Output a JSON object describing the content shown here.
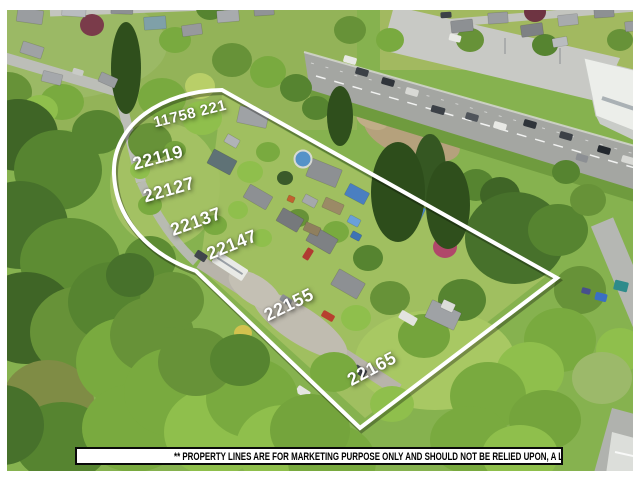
{
  "overlay": {
    "property_line_color": "#ffffff",
    "label_color": "#ffffff",
    "address_labels": [
      {
        "text": "11758 221",
        "x": 190,
        "y": 114,
        "rotation": -14,
        "size": 15
      },
      {
        "text": "22119",
        "x": 158,
        "y": 158,
        "rotation": -15,
        "size": 18
      },
      {
        "text": "22127",
        "x": 169,
        "y": 190,
        "rotation": -16,
        "size": 18
      },
      {
        "text": "22137",
        "x": 196,
        "y": 222,
        "rotation": -20,
        "size": 18
      },
      {
        "text": "22147",
        "x": 232,
        "y": 245,
        "rotation": -22,
        "size": 18
      },
      {
        "text": "22155",
        "x": 289,
        "y": 305,
        "rotation": -26,
        "size": 18
      },
      {
        "text": "22165",
        "x": 372,
        "y": 369,
        "rotation": -28,
        "size": 18
      }
    ]
  },
  "disclaimer": {
    "text": "** PROPERTY LINES ARE FOR MARKETING PURPOSE ONLY AND SHOULD NOT BE RELIED UPON, A LEGAL SURVEY IS REQUIRED",
    "text_color": "#000000",
    "background_color": "#ffffff",
    "border_color": "#0a0a0a"
  }
}
